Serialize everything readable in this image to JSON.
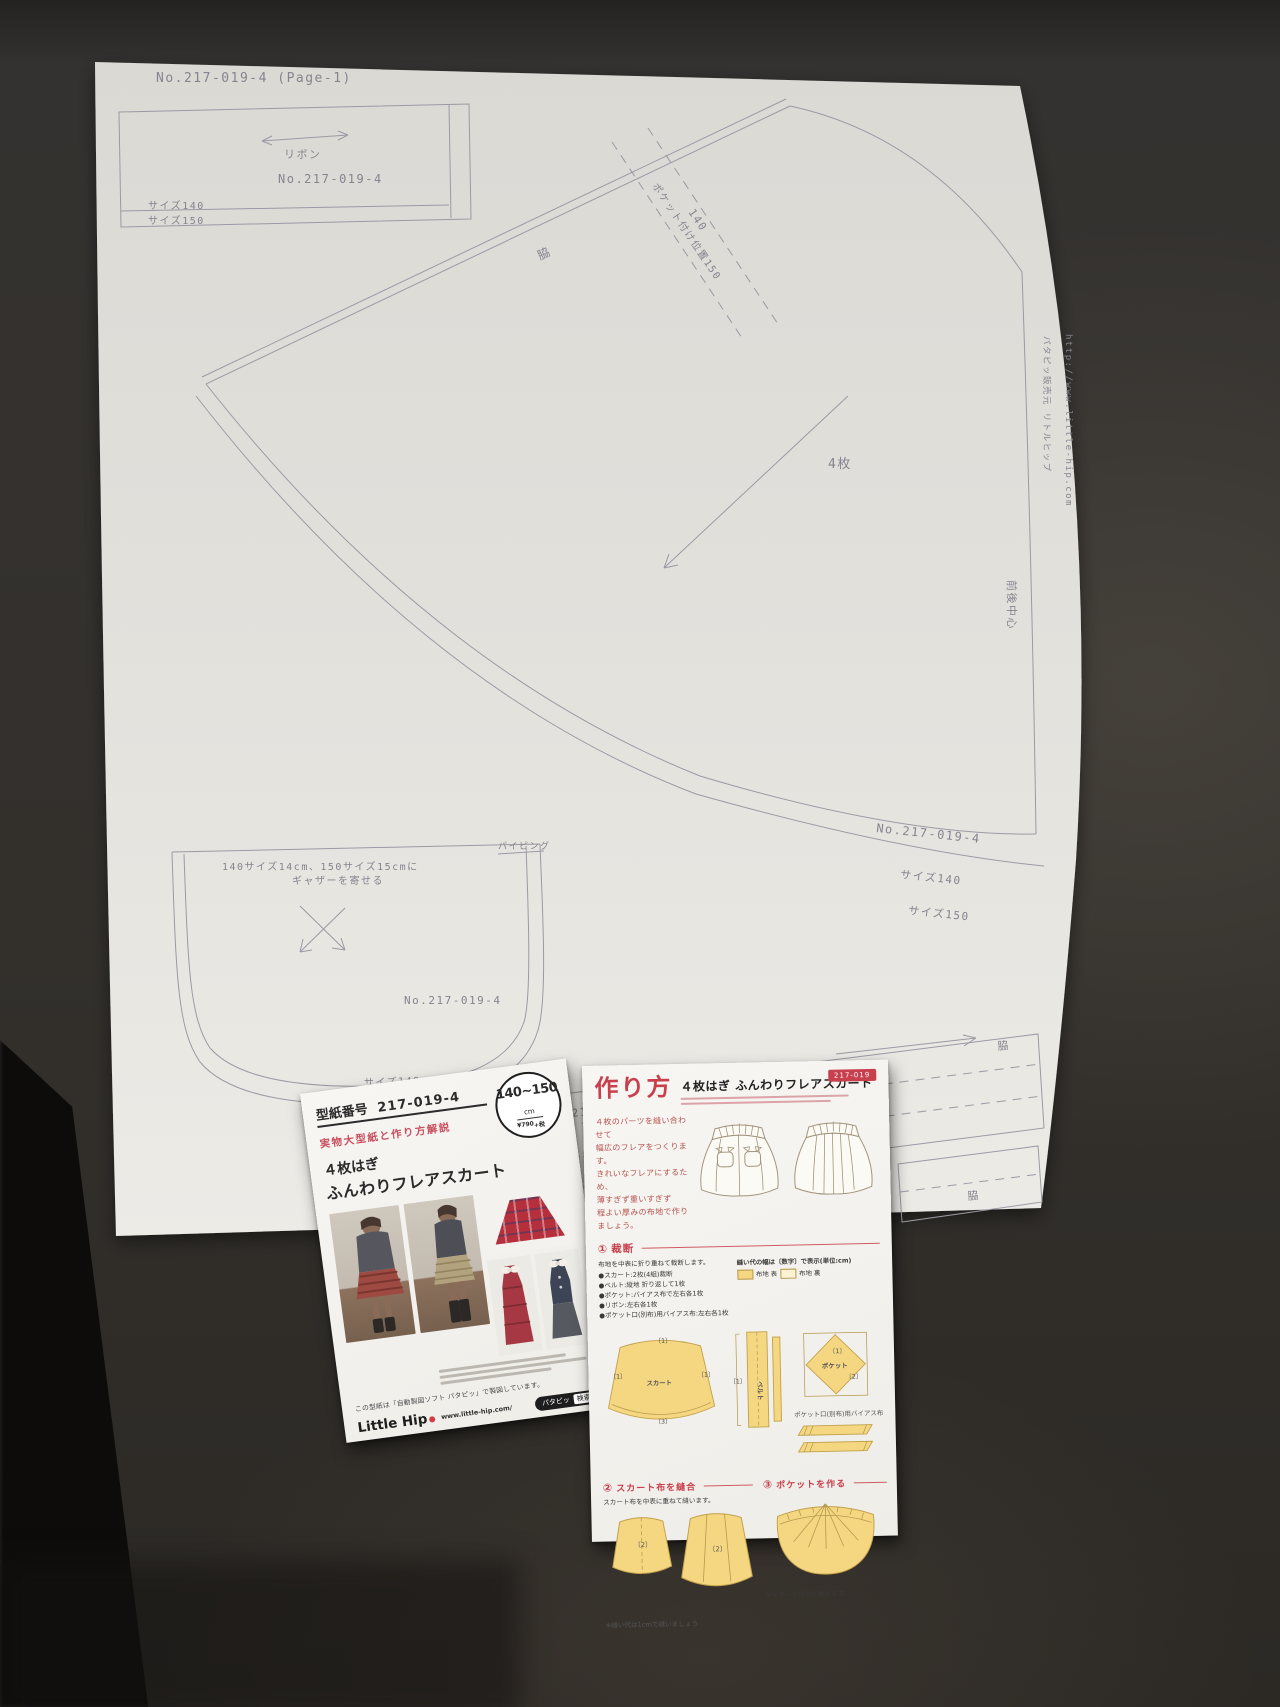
{
  "pattern_sheet": {
    "page_header": "No.217-019-4 (Page-1)",
    "ribbon_piece": {
      "label": "リボン",
      "number": "No.217-019-4",
      "size140": "サイズ140",
      "size150": "サイズ150"
    },
    "skirt_piece": {
      "side_label": "脇",
      "pocket_position_label": "ポケット付け位置150",
      "pocket_position_140": "140",
      "quantity_label": "4枚",
      "number": "No.217-019-4",
      "size140": "サイズ140",
      "size150": "サイズ150",
      "center_label": "前後中心",
      "publisher_vertical": "パタピッ販売元 リトルヒップ",
      "url_vertical": "http://www.little-hip.com"
    },
    "pocket_piece": {
      "gather_note_line1": "140サイズ14cm、150サイズ15cmに",
      "gather_note_line2": "ギャザーを寄せる",
      "piping_label": "パイピング",
      "number": "No.217-019-4",
      "size140": "サイズ140",
      "size150": "サイズ150"
    },
    "waistband_piece": {
      "number": "No.217-019-4",
      "side_left": "脇",
      "elastic_label": "ゴムを通す",
      "size150": "サイズ150",
      "side_right": "脇",
      "side_bottom": "脇"
    }
  },
  "front_leaflet": {
    "pattern_no_label": "型紙番号",
    "pattern_no": "217-019-4",
    "subtitle": "実物大型紙と作り方解説",
    "title_line1": "４枚はぎ",
    "title_line2": "ふんわりフレアスカート",
    "badge": {
      "size": "140~150",
      "unit": "cm",
      "price": "¥790",
      "tax": "+税"
    },
    "note": "この型紙は「自動製図ソフト パタピッ」で製図しています。",
    "brand": "Little Hip",
    "brand_url": "www.little-hip.com/",
    "search_brand": "パタピッ",
    "search_button": "検索"
  },
  "instruction_leaflet": {
    "header_title": "作り方",
    "header_subtitle": "４枚はぎ ふんわりフレアスカート",
    "number_badge": "217-019",
    "intro_lines": [
      "４枚のパーツを縫い合わせて",
      "幅広のフレアをつくります。",
      "きれいなフレアにするため、",
      "薄すぎず重いすぎず",
      "程よい厚みの布地で作りましょう。"
    ],
    "section1": {
      "num": "①",
      "title": "裁断",
      "lead": "布地を中表に折り重ねて裁断します。",
      "bullets": [
        "●スカート:2枚(4組)裁断",
        "●ベルト:縦地 折り返して1枚",
        "●ポケット:バイアス布で左右各1枚",
        "●リボン:左右各1枚",
        "●ポケット口(別布)用バイアス布:左右各1枚"
      ],
      "seam_note": "縫い代の幅は〔数字〕で表示(単位:cm)",
      "legend_front": "布地 表",
      "legend_back": "布地 裏",
      "label_skirt": "スカート",
      "label_belt": "ベルト",
      "label_pocket": "ポケット",
      "label_bias": "ポケット口(別布)用バイアス布",
      "mark1": "〔1〕",
      "mark2": "〔2〕",
      "mark3": "〔3〕"
    },
    "section2": {
      "num": "②",
      "title": "スカート布を縫合",
      "lead": "スカート布を中表に重ねて縫います。"
    },
    "section3": {
      "num": "③",
      "title": "ポケットを作る",
      "lead": "ギャザーを均等に寄せます。"
    },
    "bottom_note": "※縫い代は1cmで縫いましょう"
  }
}
